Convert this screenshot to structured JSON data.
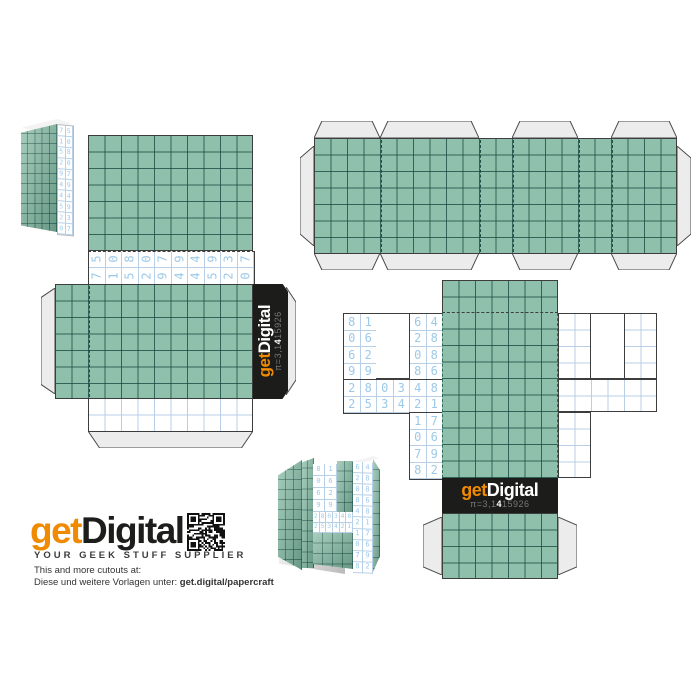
{
  "colors": {
    "teal": "#8fc0ab",
    "teal_line": "#2e6a5c",
    "digit_blue": "#9cc9e8",
    "blue_line": "#b7d0e8",
    "outline": "#3d3d3d",
    "tab_gray": "#ececec",
    "banner_black": "#1c1c1a",
    "brand_orange": "#f08a00"
  },
  "digits": {
    "stick_face_rows": [
      [
        "5",
        "0",
        "8",
        "0",
        "7",
        "9",
        "4",
        "9",
        "3",
        "7"
      ],
      [
        "7",
        "1",
        "5",
        "2",
        "9",
        "4",
        "4",
        "5",
        "2",
        "0"
      ]
    ],
    "pi_left_wing": [
      [
        "8",
        "1"
      ],
      [
        "0",
        "6"
      ],
      [
        "6",
        "2"
      ],
      [
        "9",
        "9"
      ]
    ],
    "pi_wide_rows": [
      [
        "2",
        "8",
        "0",
        "3",
        "4",
        "8"
      ],
      [
        "2",
        "5",
        "3",
        "4",
        "2",
        "1"
      ]
    ],
    "pi_mid_top": [
      [
        "6",
        "4"
      ],
      [
        "2",
        "8"
      ],
      [
        "0",
        "8"
      ],
      [
        "8",
        "6"
      ]
    ],
    "pi_mid_bottom": [
      [
        "1",
        "7"
      ],
      [
        "0",
        "6"
      ],
      [
        "7",
        "9"
      ],
      [
        "8",
        "2"
      ]
    ],
    "preview_stick_rows": [
      [
        "7",
        "5"
      ],
      [
        "1",
        "0"
      ],
      [
        "5",
        "8"
      ],
      [
        "2",
        "0"
      ],
      [
        "9",
        "7"
      ],
      [
        "4",
        "9"
      ],
      [
        "4",
        "4"
      ],
      [
        "5",
        "9"
      ],
      [
        "2",
        "3"
      ],
      [
        "0",
        "7"
      ]
    ],
    "preview_pi_right": [
      [
        "6",
        "4"
      ],
      [
        "2",
        "8"
      ],
      [
        "0",
        "8"
      ],
      [
        "8",
        "6"
      ],
      [
        "4",
        "8"
      ],
      [
        "2",
        "1"
      ],
      [
        "1",
        "7"
      ],
      [
        "0",
        "6"
      ],
      [
        "7",
        "9"
      ],
      [
        "8",
        "2"
      ]
    ]
  },
  "banner": {
    "logo_get": "get",
    "logo_digital": "Digital",
    "pi_prefix": "π=3,1",
    "pi_bold": "4",
    "pi_rest": "15926"
  },
  "footer": {
    "logo_get": "get",
    "logo_digital": "Digital",
    "tagline": "YOUR GEEK STUFF SUPPLIER",
    "line1": "This and more cutouts at:",
    "line2": "Diese und weitere Vorlagen unter: ",
    "line2_bold": "get.digital/papercraft"
  }
}
